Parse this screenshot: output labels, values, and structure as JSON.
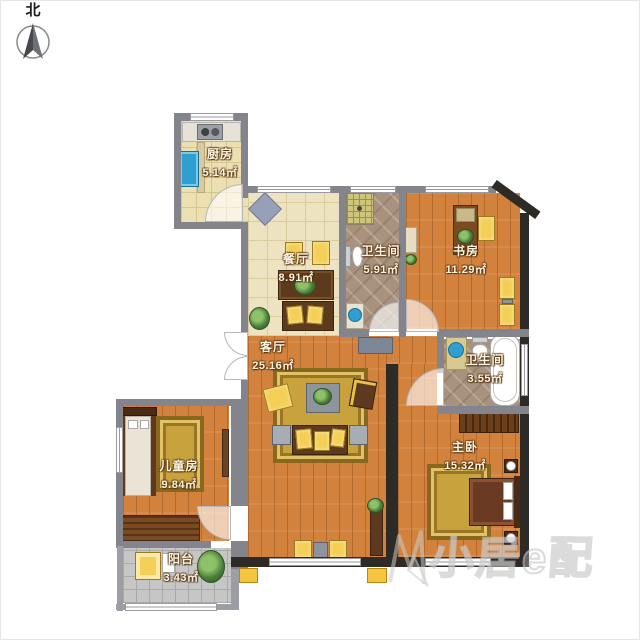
{
  "compass": {
    "label": "北"
  },
  "watermark": {
    "text": "小居e配"
  },
  "rooms": {
    "kitchen": {
      "name": "厨房",
      "area": "5.14㎡"
    },
    "dining": {
      "name": "餐厅",
      "area": "8.91㎡"
    },
    "bath_main": {
      "name": "卫生间",
      "area": "5.91㎡"
    },
    "study": {
      "name": "书房",
      "area": "11.29㎡"
    },
    "living": {
      "name": "客厅",
      "area": "25.16㎡"
    },
    "bath_small": {
      "name": "卫生间",
      "area": "3.55㎡"
    },
    "kids": {
      "name": "儿童房",
      "area": "9.84㎡"
    },
    "master": {
      "name": "主卧",
      "area": "15.32㎡"
    },
    "balcony": {
      "name": "阳台",
      "area": "3.43㎡"
    }
  },
  "colors": {
    "wood_floor": "#d2823d",
    "cream_tile": "#eee3c0",
    "kitchen_tile": "#ecdfb2",
    "bath_marble": "#a8927e",
    "balcony_tile": "#c6c6c6",
    "wall_gray": "#84848c",
    "wall_dark": "#2e2a25",
    "rug_gold": "#c8a23c",
    "cushion_yellow": "#f3cf57",
    "fixture_blue": "#2e9fd0",
    "label_text": "#fdf6e3"
  }
}
